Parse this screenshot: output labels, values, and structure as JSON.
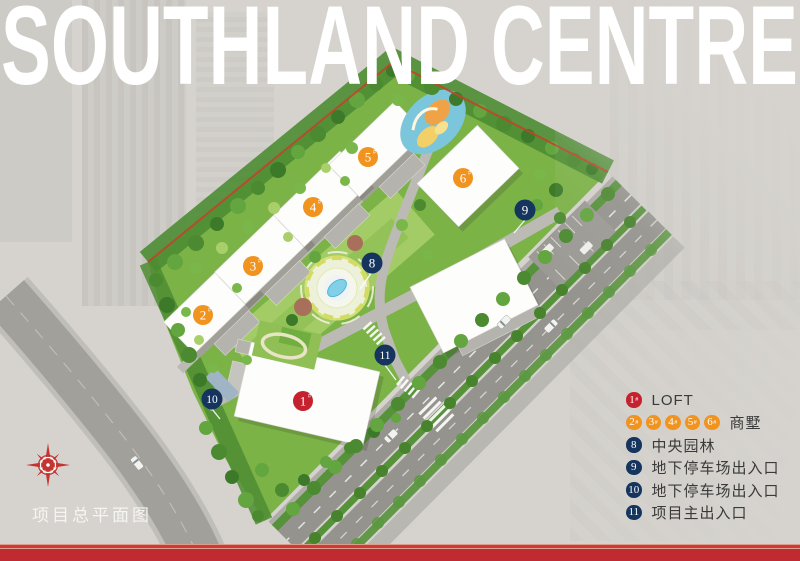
{
  "title": "SOUTHLAND CENTRE",
  "caption": "项目总平面图",
  "colors": {
    "marker_red": "#c5222f",
    "marker_orange": "#f0931f",
    "marker_navy": "#16355e",
    "site_green": "#7cb347",
    "banner_red": "#bf2b30",
    "title_white": "#ffffff"
  },
  "map_markers": [
    {
      "id": "building-1",
      "label": "1",
      "suffix": "#",
      "color": "#c5222f"
    },
    {
      "id": "building-2",
      "label": "2",
      "suffix": "#",
      "color": "#f0931f"
    },
    {
      "id": "building-3",
      "label": "3",
      "suffix": "#",
      "color": "#f0931f"
    },
    {
      "id": "building-4",
      "label": "4",
      "suffix": "#",
      "color": "#f0931f"
    },
    {
      "id": "building-5",
      "label": "5",
      "suffix": "#",
      "color": "#f0931f"
    },
    {
      "id": "building-6",
      "label": "6",
      "suffix": "#",
      "color": "#f0931f"
    },
    {
      "id": "central-garden",
      "label": "8",
      "suffix": "",
      "color": "#16355e"
    },
    {
      "id": "parking-entrance-east",
      "label": "9",
      "suffix": "",
      "color": "#16355e"
    },
    {
      "id": "parking-entrance-west",
      "label": "10",
      "suffix": "",
      "color": "#16355e"
    },
    {
      "id": "main-entrance",
      "label": "11",
      "suffix": "",
      "color": "#16355e"
    }
  ],
  "legend": {
    "items": [
      {
        "markers": [
          "1"
        ],
        "suffix": "#",
        "label": "LOFT",
        "color": "#c5222f"
      },
      {
        "markers": [
          "2",
          "3",
          "4",
          "5",
          "6"
        ],
        "suffix": "#",
        "label": "商墅",
        "color": "#f0931f"
      },
      {
        "markers": [
          "8"
        ],
        "suffix": "",
        "label": "中央园林",
        "color": "#16355e"
      },
      {
        "markers": [
          "9"
        ],
        "suffix": "",
        "label": "地下停车场出入口",
        "color": "#16355e"
      },
      {
        "markers": [
          "10"
        ],
        "suffix": "",
        "label": "地下停车场出入口",
        "color": "#16355e"
      },
      {
        "markers": [
          "11"
        ],
        "suffix": "",
        "label": "项目主出入口",
        "color": "#16355e"
      }
    ]
  }
}
